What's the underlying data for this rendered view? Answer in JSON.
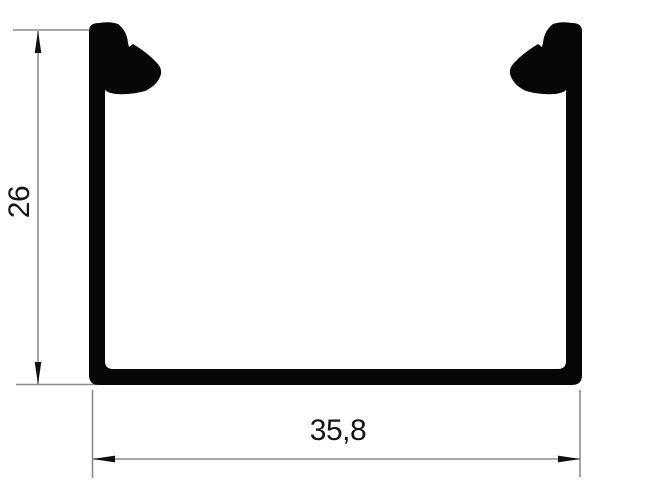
{
  "drawing": {
    "kind": "channel-profile-cross-section",
    "dimensions": {
      "height": {
        "label": "26",
        "orientation": "vertical"
      },
      "width": {
        "label": "35,8",
        "orientation": "horizontal"
      }
    },
    "colors": {
      "background": "#ffffff",
      "profile_fill": "#070707",
      "dimension_line": "#8c8c8c",
      "arrow_fill": "#101010",
      "text": "#151515"
    }
  }
}
